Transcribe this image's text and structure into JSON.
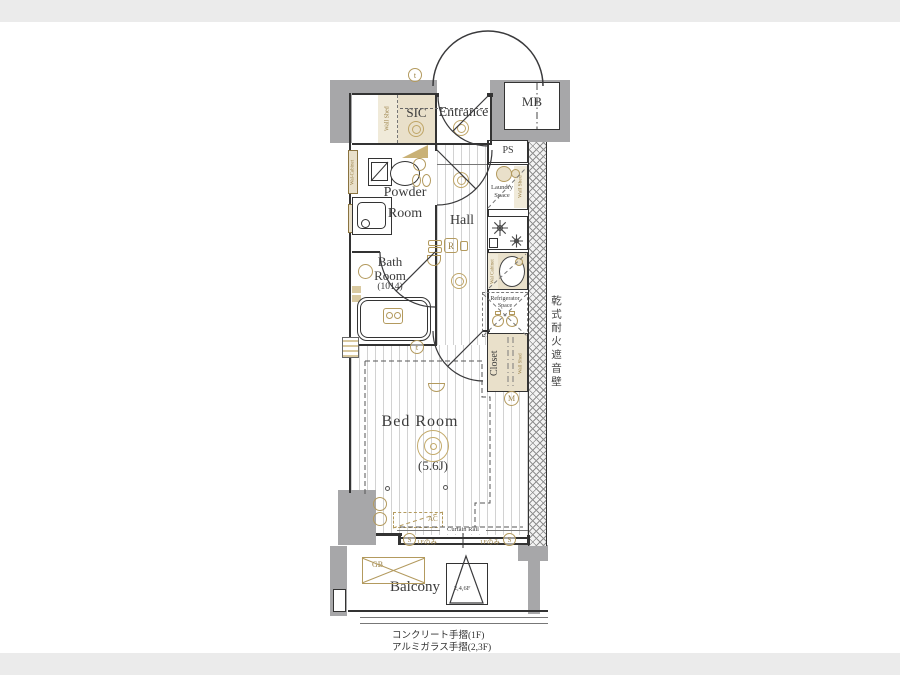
{
  "plan": {
    "rooms": {
      "entrance": "Entrance",
      "sic": "SIC",
      "mb": "MB",
      "ps": "PS",
      "powder_l1": "Powder",
      "powder_l2": "Room",
      "hall": "Hall",
      "bath_l1": "Bath",
      "bath_l2": "Room",
      "bath_size": "(1014)",
      "laundry_l1": "Laundry",
      "laundry_l2": "Space",
      "fridge_l1": "Refrigerator",
      "fridge_l2": "Space",
      "closet": "Closet",
      "bedroom": "Bed Room",
      "bedroom_size": "(5.6J)",
      "balcony": "Balcony"
    },
    "labels": {
      "wall_shed": "Wall Shed",
      "wall_cabinet": "Wal Cabinet",
      "wall_cabinet_powder": "Wal-Cabinet",
      "curtain_rail": "Curtain Rail",
      "ac": "AC",
      "gb": "GB",
      "first_floor_only": "1Fのみ",
      "triangle_floors": "2,4,6F"
    },
    "symbols": {
      "t": "t",
      "s": "S",
      "m": "M",
      "r": "R"
    },
    "notes": {
      "soundproof_wall": "乾式耐火遮音壁",
      "handrail_1f": "コンクリート手摺(1F)",
      "handrail_23f": "アルミガラス手摺(2,3F)"
    },
    "colors": {
      "wall_gray": "#a7a7a9",
      "accent_tan": "#b39a5e",
      "accent_fill": "#e9e0ca",
      "line": "#333333",
      "band": "#ebebeb"
    }
  }
}
